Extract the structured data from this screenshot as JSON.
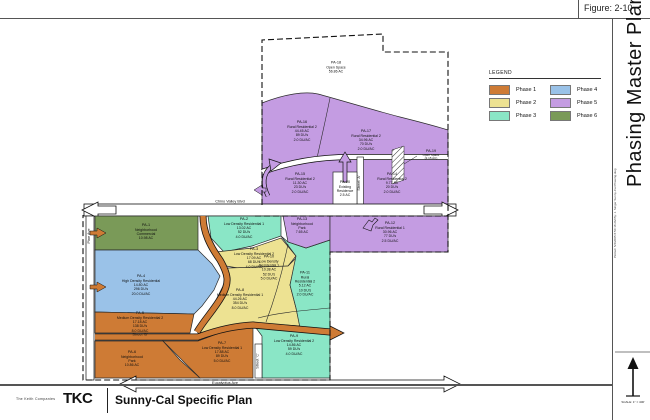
{
  "figure": {
    "label": "Figure: 2-10"
  },
  "sidebar": {
    "title": "Phasing Master Plan",
    "print_info": "Plotted: 5/4/2005 8:50:18 AM  By: J. Singer  Sunny-Cal Phasing.dwg",
    "scale_note": "SCALE: 1\" = 400'"
  },
  "legend": {
    "title": "LEGEND",
    "items": [
      {
        "label": "Phase 1",
        "color": "#CE7B35"
      },
      {
        "label": "Phase 2",
        "color": "#EDE292"
      },
      {
        "label": "Phase 3",
        "color": "#8AE6C6"
      },
      {
        "label": "Phase 4",
        "color": "#9AC2E8"
      },
      {
        "label": "Phase 5",
        "color": "#C49CE2"
      },
      {
        "label": "Phase 6",
        "color": "#7A9A58"
      }
    ]
  },
  "titleblock": {
    "company": "The Keith Companies",
    "logo": "TKC",
    "title": "Sunny-Cal Specific Plan"
  },
  "roads": {
    "chino": "Chino Valley Blvd",
    "eucalyptus": "Eucalyptus Ave",
    "street_a": "Street 'A'",
    "street_b": "Street 'B'",
    "street_c": "Street 'C'",
    "pine": "Pine Ave"
  },
  "parcels": [
    {
      "id": "PA-1",
      "lines": [
        "PA-1",
        "Neighborhood",
        "Commercial",
        "10.98 AC"
      ]
    },
    {
      "id": "PA-2",
      "lines": [
        "PA-2",
        "Low Density Residential 1",
        "13.02 AC",
        "52 DU's",
        "4.0 DU/AC"
      ]
    },
    {
      "id": "PA-3",
      "lines": [
        "PA-3",
        "Low Density Residential 2",
        "17.09 AC",
        "68 DU's",
        "4.0 DU/AC"
      ]
    },
    {
      "id": "PA-4",
      "lines": [
        "PA-4",
        "High Density Residential",
        "14.80 AC",
        "296 DU's",
        "20.0 DU/AC"
      ]
    },
    {
      "id": "PA-5",
      "lines": [
        "PA-5",
        "Medium Density Residential 2",
        "17.18 AC",
        "138 DU's",
        "8.0 DU/AC"
      ]
    },
    {
      "id": "PA-6",
      "lines": [
        "PA-6",
        "Neighborhood",
        "Park",
        "10.86 AC"
      ]
    },
    {
      "id": "PA-7",
      "lines": [
        "PA-7",
        "Low Density Residential 1",
        "17.88 AC",
        "89 DU's",
        "5.0 DU/AC"
      ]
    },
    {
      "id": "PA-8",
      "lines": [
        "PA-8",
        "Medium Density Residential 1",
        "44.26 AC",
        "354 DU's",
        "8.0 DU/AC"
      ]
    },
    {
      "id": "PA-9",
      "lines": [
        "PA-9",
        "Low Density Residential 2",
        "14.86 AC",
        "59 DU's",
        "4.0 DU/AC"
      ]
    },
    {
      "id": "PA-10",
      "lines": [
        "PA-10",
        "Low Density",
        "Residential 1",
        "10.38 AC",
        "52 DU's",
        "5.0 DU/AC"
      ]
    },
    {
      "id": "PA-11",
      "lines": [
        "PA-11",
        "Rural",
        "Residential 2",
        "5.12 AC",
        "10 DU's",
        "2.0 DU/AC"
      ]
    },
    {
      "id": "PA-12",
      "lines": [
        "PA-12",
        "Rural Residential 1",
        "30.96 AC",
        "77 DU's",
        "2.5 DU/AC"
      ]
    },
    {
      "id": "PA-13",
      "lines": [
        "PA-13",
        "Neighborhood",
        "Park",
        "7.65 AC"
      ]
    },
    {
      "id": "PA-14",
      "lines": [
        "PA-14",
        "Rural Residential 2",
        "9.77 AC",
        "20 DU's",
        "2.0 DU/AC"
      ]
    },
    {
      "id": "PA-15",
      "lines": [
        "PA-15",
        "Rural Residential 2",
        "11.30 AC",
        "23 DU's",
        "2.0 DU/AC"
      ]
    },
    {
      "id": "PA-16",
      "lines": [
        "PA-16",
        "Rural Residential 2",
        "44.45 AC",
        "89 DU's",
        "2.0 DU/AC"
      ]
    },
    {
      "id": "PA-17",
      "lines": [
        "PA-17",
        "Rural Residential 2",
        "34.96 AC",
        "70 DU's",
        "2.0 DU/AC"
      ]
    },
    {
      "id": "PA-18",
      "lines": [
        "PA-18",
        "Open Space",
        "56.86 AC"
      ]
    },
    {
      "id": "PA-19",
      "lines": [
        "PA-19",
        "Open Space",
        "(2.15 AC)"
      ]
    },
    {
      "id": "PA-20",
      "lines": [
        "PA-20",
        "Existing",
        "Residence",
        "2.5 AC"
      ]
    }
  ]
}
